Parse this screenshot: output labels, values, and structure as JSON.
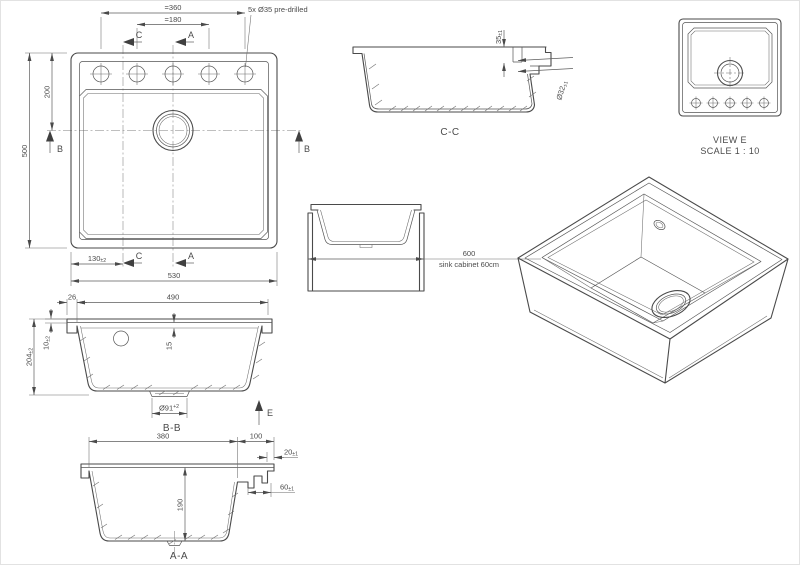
{
  "meta": {
    "background": "#ffffff",
    "line_color": "#4a4a4a"
  },
  "plan_view": {
    "dim_hole_span": "=360",
    "dim_hole_span_inner": "=180",
    "holes_note": "5x Ø35 pre-drilled",
    "dim_height": "500",
    "dim_center_from_top": "200",
    "dim_c_offset": "130",
    "dim_c_offset_tol": "±2",
    "dim_width": "530",
    "marker_c": "C",
    "marker_a": "A",
    "marker_b": "B"
  },
  "section_cc": {
    "title": "C-C",
    "dim_deck_depth": "35",
    "dim_deck_depth_tol": "±1",
    "dim_hole_dia": "Ø32",
    "dim_hole_dia_tol": "±1"
  },
  "view_e": {
    "title": "VIEW E",
    "scale": "SCALE 1 : 10"
  },
  "cabinet_view": {
    "dim_width": "600",
    "caption": "sink cabinet 60cm"
  },
  "section_bb": {
    "title": "B-B",
    "dim_lip": "26",
    "dim_inner_width": "490",
    "dim_rim": "10",
    "dim_rim_tol": "±2",
    "dim_height": "204",
    "dim_height_tol": "±2",
    "dim_ledge": "15",
    "dim_drain_dia": "Ø91",
    "dim_drain_dia_tol": "+2",
    "marker_e": "E"
  },
  "section_aa": {
    "title": "A-A",
    "dim_bowl": "380",
    "dim_deck": "100",
    "dim_step": "20",
    "dim_step_tol": "±1",
    "dim_ledge": "60",
    "dim_ledge_tol": "±1",
    "dim_depth": "190"
  }
}
